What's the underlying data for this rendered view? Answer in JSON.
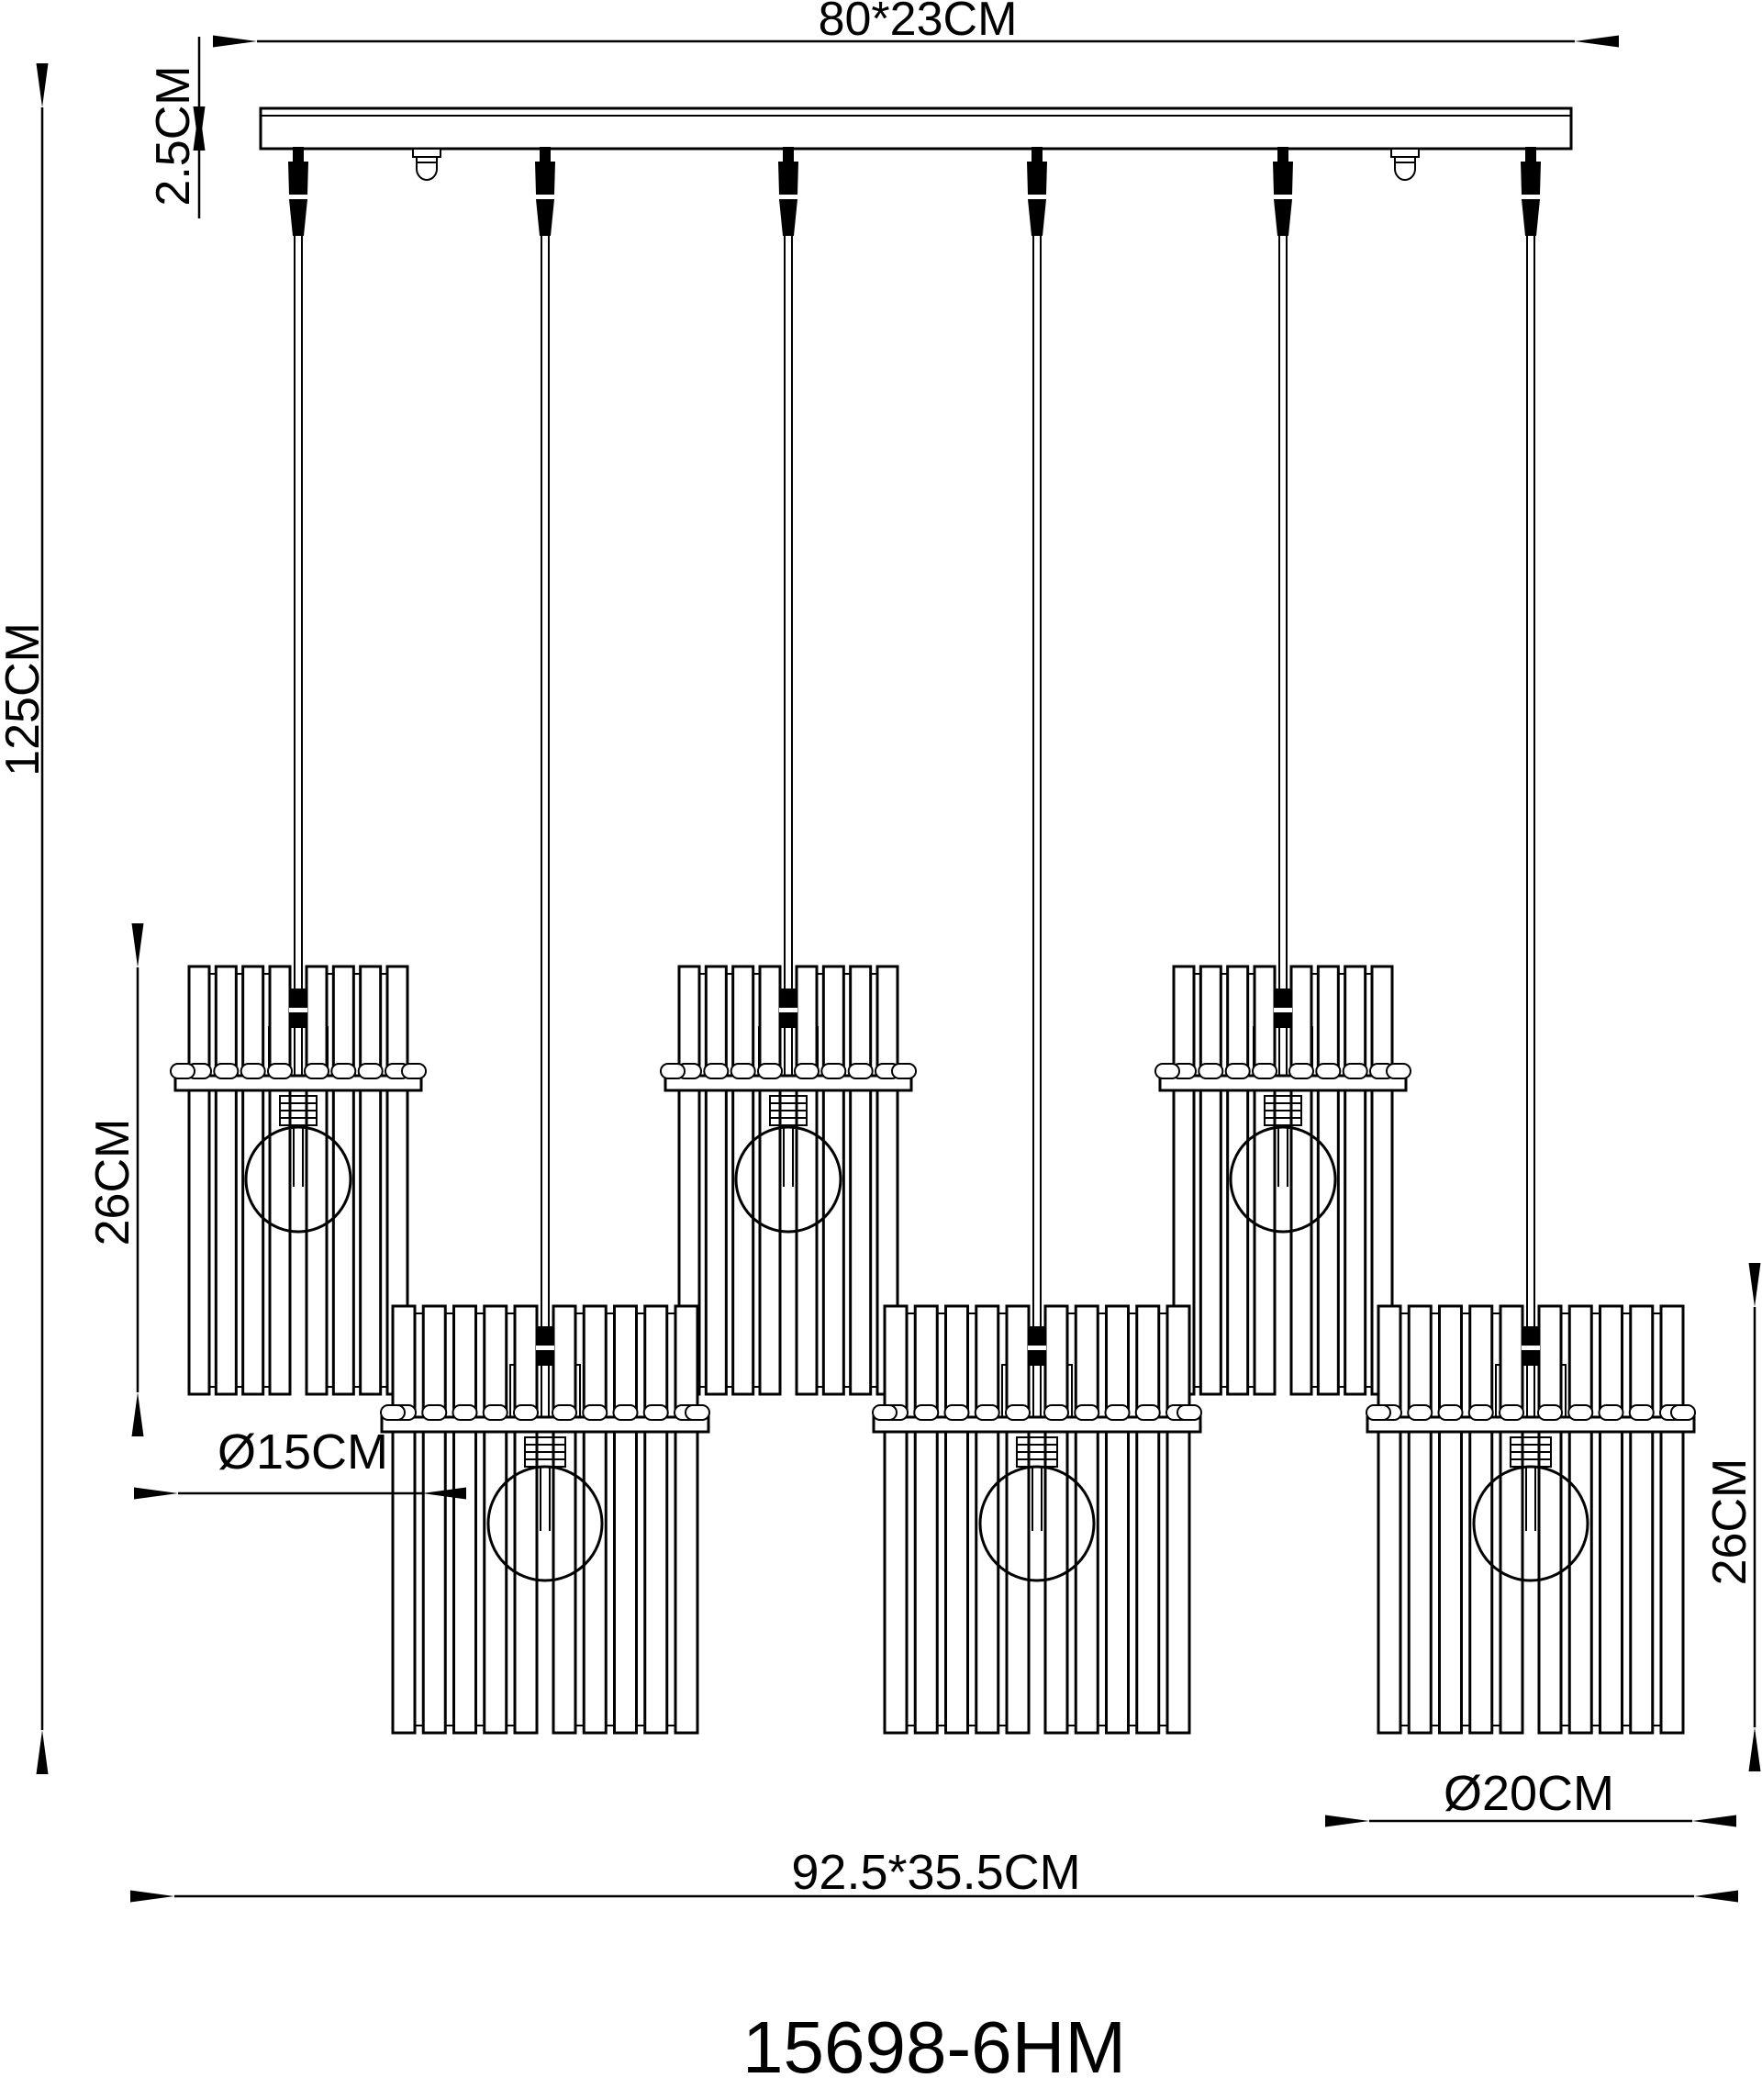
{
  "page": {
    "background_color": "#ffffff",
    "line_color": "#000000"
  },
  "drawing": {
    "type": "pendant-lamp-technical-drawing",
    "model_number": "15698-6HM",
    "shade_count_small": 3,
    "shade_count_large": 3,
    "dimensions": {
      "canopy_width": "80*23CM",
      "canopy_thickness": "2.5CM",
      "overall_drop": "125CM",
      "small_shade_height": "26CM",
      "small_shade_diameter": "Ø15CM",
      "large_shade_diameter": "Ø20CM",
      "large_shade_height": "26CM",
      "overall_size": "92.5*35.5CM"
    }
  }
}
